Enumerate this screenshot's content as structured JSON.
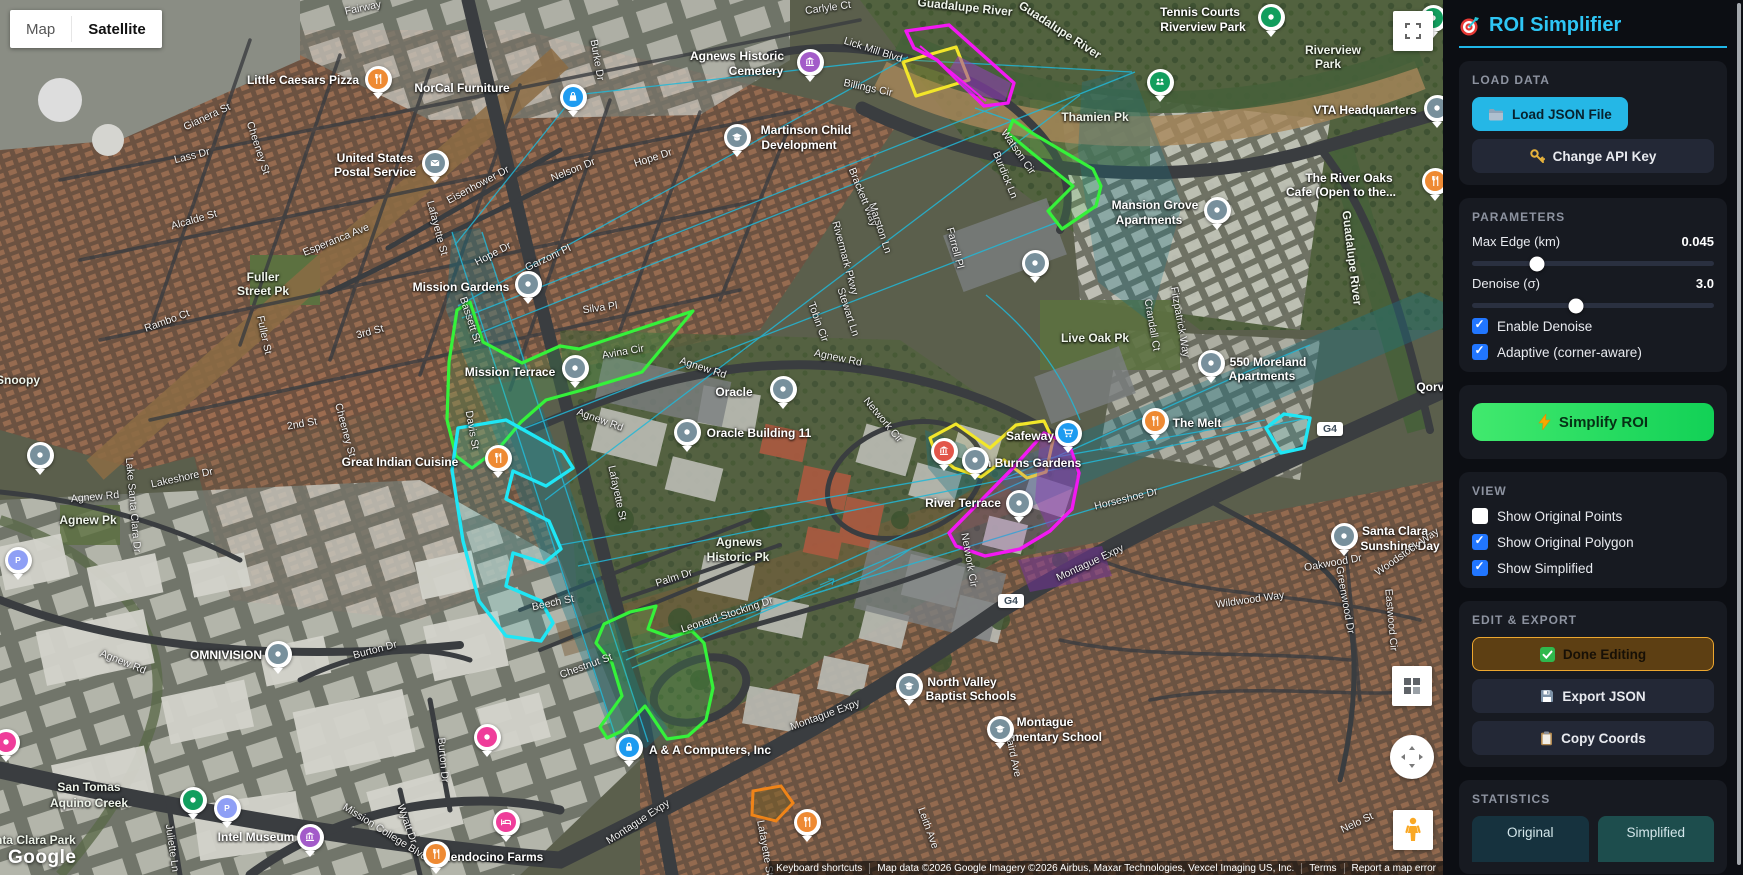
{
  "sidebar": {
    "title": "ROI Simplifier",
    "load": {
      "header": "LOAD DATA",
      "load_button": "Load JSON File",
      "api_button": "Change API Key"
    },
    "parameters": {
      "header": "PARAMETERS",
      "max_edge": {
        "label": "Max Edge (km)",
        "value": "0.045",
        "pct": 27
      },
      "denoise": {
        "label": "Denoise (σ)",
        "value": "3.0",
        "pct": 43
      },
      "checkboxes": [
        {
          "label": "Enable Denoise",
          "checked": true
        },
        {
          "label": "Adaptive (corner-aware)",
          "checked": true
        }
      ]
    },
    "simplify_button": "Simplify ROI",
    "view": {
      "header": "VIEW",
      "checkboxes": [
        {
          "label": "Show Original Points",
          "checked": false
        },
        {
          "label": "Show Original Polygon",
          "checked": true
        },
        {
          "label": "Show Simplified",
          "checked": true
        }
      ]
    },
    "edit": {
      "header": "EDIT & EXPORT",
      "done_button": "Done Editing",
      "export_button": "Export JSON",
      "copy_button": "Copy Coords"
    },
    "statistics": {
      "header": "STATISTICS",
      "original_label": "Original",
      "simplified_label": "Simplified"
    }
  },
  "map": {
    "type_control": {
      "map": "Map",
      "satellite": "Satellite"
    },
    "google_logo": "Google",
    "attribution": {
      "keyboard": "Keyboard shortcuts",
      "map_data": "Map data ©2026 Google Imagery ©2026 Airbus, Maxar Technologies, Vexcel Imaging US, Inc.",
      "terms": "Terms",
      "report": "Report a map error"
    },
    "highway_badges": [
      {
        "t": "G4",
        "x": 1330,
        "y": 429
      },
      {
        "t": "G4",
        "x": 1011,
        "y": 601
      }
    ],
    "roi_colors": {
      "original": "#22b8d8",
      "simplified_green": "#35f23a",
      "cyan": "#1fe6f5",
      "yellow": "#f2e62a",
      "magenta": "#f318f3",
      "orange": "#f08418"
    },
    "labels": [
      {
        "t": "Little Caesars Pizza",
        "x": 303,
        "y": 80,
        "r": 0,
        "k": "poi"
      },
      {
        "t": "NorCal Furniture",
        "x": 462,
        "y": 88,
        "r": 0,
        "k": "poi"
      },
      {
        "t": "United States",
        "x": 375,
        "y": 158,
        "r": 0,
        "k": "poi"
      },
      {
        "t": "Postal Service",
        "x": 375,
        "y": 172,
        "r": 0,
        "k": "poi"
      },
      {
        "t": "Agnews Historic",
        "x": 737,
        "y": 56,
        "r": 0,
        "k": "poi"
      },
      {
        "t": "Cemetery",
        "x": 756,
        "y": 71,
        "r": 0,
        "k": "poi"
      },
      {
        "t": "Martinson Child",
        "x": 806,
        "y": 130,
        "r": 0,
        "k": "poi"
      },
      {
        "t": "Development",
        "x": 799,
        "y": 145,
        "r": 0,
        "k": "poi"
      },
      {
        "t": "Tennis Courts",
        "x": 1200,
        "y": 12,
        "r": 0,
        "k": "poi"
      },
      {
        "t": "Riverview Park",
        "x": 1203,
        "y": 27,
        "r": 0,
        "k": "poi"
      },
      {
        "t": "Riverview",
        "x": 1333,
        "y": 50,
        "r": 0,
        "k": "park"
      },
      {
        "t": "Park",
        "x": 1328,
        "y": 64,
        "r": 0,
        "k": "park"
      },
      {
        "t": "VTA Headquarters",
        "x": 1365,
        "y": 110,
        "r": 0,
        "k": "poi"
      },
      {
        "t": "The River Oaks",
        "x": 1349,
        "y": 178,
        "r": 0,
        "k": "poi"
      },
      {
        "t": "Cafe (Open to the...",
        "x": 1341,
        "y": 192,
        "r": 0,
        "k": "poi"
      },
      {
        "t": "Mansion Grove",
        "x": 1155,
        "y": 205,
        "r": 0,
        "k": "poi"
      },
      {
        "t": "Apartments",
        "x": 1149,
        "y": 220,
        "r": 0,
        "k": "poi"
      },
      {
        "t": "550 Moreland",
        "x": 1268,
        "y": 362,
        "r": 0,
        "k": "poi"
      },
      {
        "t": "Apartments",
        "x": 1262,
        "y": 376,
        "r": 0,
        "k": "poi"
      },
      {
        "t": "The Melt",
        "x": 1197,
        "y": 423,
        "r": 0,
        "k": "poi"
      },
      {
        "t": "Safeway",
        "x": 1030,
        "y": 436,
        "r": 0,
        "k": "poi"
      },
      {
        "t": "John Burns Gardens",
        "x": 1022,
        "y": 463,
        "r": 0,
        "k": "poi"
      },
      {
        "t": "River Terrace",
        "x": 963,
        "y": 503,
        "r": 0,
        "k": "poi"
      },
      {
        "t": "Mission Gardens",
        "x": 461,
        "y": 287,
        "r": 0,
        "k": "poi"
      },
      {
        "t": "Mission Terrace",
        "x": 510,
        "y": 372,
        "r": 0,
        "k": "poi"
      },
      {
        "t": "Oracle",
        "x": 734,
        "y": 392,
        "r": 0,
        "k": "poi"
      },
      {
        "t": "Oracle Building 11",
        "x": 759,
        "y": 433,
        "r": 0,
        "k": "poi"
      },
      {
        "t": "Great Indian Cuisine",
        "x": 400,
        "y": 462,
        "r": 0,
        "k": "poi"
      },
      {
        "t": "A & A Computers, Inc",
        "x": 710,
        "y": 750,
        "r": 0,
        "k": "poi"
      },
      {
        "t": "North Valley",
        "x": 962,
        "y": 682,
        "r": 0,
        "k": "poi"
      },
      {
        "t": "Baptist Schools",
        "x": 971,
        "y": 696,
        "r": 0,
        "k": "poi"
      },
      {
        "t": "Mendocino Farms",
        "x": 492,
        "y": 857,
        "r": 0,
        "k": "poi"
      },
      {
        "t": "Intel Museum",
        "x": 256,
        "y": 837,
        "r": 0,
        "k": "poi"
      },
      {
        "t": "OMNIVISION",
        "x": 226,
        "y": 655,
        "r": 0,
        "k": "poi"
      },
      {
        "t": "Montague",
        "x": 1045,
        "y": 722,
        "r": 0,
        "k": "poi"
      },
      {
        "t": "Elementary School",
        "x": 1048,
        "y": 737,
        "r": 0,
        "k": "poi"
      },
      {
        "t": "Santa Clara",
        "x": 1395,
        "y": 531,
        "r": 0,
        "k": "poi"
      },
      {
        "t": "Sunshine Day",
        "x": 1400,
        "y": 546,
        "r": 0,
        "k": "poi"
      },
      {
        "t": "Qorvo",
        "x": 1434,
        "y": 387,
        "r": 0,
        "k": "poi"
      },
      {
        "t": "Thamien Pk",
        "x": 1095,
        "y": 117,
        "r": 0,
        "k": "park"
      },
      {
        "t": "Live Oak Pk",
        "x": 1095,
        "y": 338,
        "r": 0,
        "k": "park"
      },
      {
        "t": "Agnews",
        "x": 739,
        "y": 542,
        "r": 0,
        "k": "park"
      },
      {
        "t": "Historic Pk",
        "x": 738,
        "y": 557,
        "r": 0,
        "k": "park"
      },
      {
        "t": "Fuller",
        "x": 263,
        "y": 277,
        "r": 0,
        "k": "park"
      },
      {
        "t": "Street Pk",
        "x": 263,
        "y": 291,
        "r": 0,
        "k": "park"
      },
      {
        "t": "Agnew Pk",
        "x": 88,
        "y": 520,
        "r": 0,
        "k": "park"
      },
      {
        "t": "San Tomas",
        "x": 89,
        "y": 787,
        "r": 0,
        "k": "park"
      },
      {
        "t": "Aquino Creek",
        "x": 89,
        "y": 803,
        "r": 0,
        "k": "park"
      },
      {
        "t": "Santa Clara Park",
        "x": 28,
        "y": 840,
        "r": 0,
        "k": "park"
      },
      {
        "t": "Snoopy",
        "x": 18,
        "y": 380,
        "r": 0,
        "k": "park"
      },
      {
        "t": "Guadalupe River",
        "x": 965,
        "y": 7,
        "r": 6,
        "k": "park"
      },
      {
        "t": "Guadalupe River",
        "x": 1060,
        "y": 30,
        "r": 33,
        "k": "park"
      },
      {
        "t": "Guadalupe River",
        "x": 1352,
        "y": 258,
        "r": 83,
        "k": "park"
      },
      {
        "t": "Fairway",
        "x": 363,
        "y": 8,
        "r": -12,
        "k": "road"
      },
      {
        "t": "Carlyle Ct",
        "x": 828,
        "y": 8,
        "r": -8,
        "k": "road"
      },
      {
        "t": "Lick Mill Blvd",
        "x": 873,
        "y": 50,
        "r": 18,
        "k": "road"
      },
      {
        "t": "Billings Cir",
        "x": 868,
        "y": 88,
        "r": 12,
        "k": "road"
      },
      {
        "t": "Burke Dr",
        "x": 597,
        "y": 60,
        "r": 80,
        "k": "road"
      },
      {
        "t": "Hope Dr",
        "x": 653,
        "y": 158,
        "r": -18,
        "k": "road"
      },
      {
        "t": "Nelson Dr",
        "x": 573,
        "y": 170,
        "r": -22,
        "k": "road"
      },
      {
        "t": "Eisenhower Dr",
        "x": 478,
        "y": 185,
        "r": -28,
        "k": "road"
      },
      {
        "t": "Hope Dr",
        "x": 493,
        "y": 254,
        "r": -28,
        "k": "road"
      },
      {
        "t": "Garzoni Pl",
        "x": 548,
        "y": 258,
        "r": -25,
        "k": "road"
      },
      {
        "t": "Silva Pl",
        "x": 600,
        "y": 308,
        "r": -8,
        "k": "road"
      },
      {
        "t": "Avina Cir",
        "x": 623,
        "y": 352,
        "r": -10,
        "k": "road"
      },
      {
        "t": "Lass Dr",
        "x": 192,
        "y": 156,
        "r": -14,
        "k": "road"
      },
      {
        "t": "Gianera St",
        "x": 207,
        "y": 117,
        "r": -25,
        "k": "road"
      },
      {
        "t": "Cheeney St",
        "x": 258,
        "y": 148,
        "r": 72,
        "k": "road"
      },
      {
        "t": "Cheeney St",
        "x": 345,
        "y": 430,
        "r": 75,
        "k": "road"
      },
      {
        "t": "Alcalde St",
        "x": 194,
        "y": 220,
        "r": -16,
        "k": "road"
      },
      {
        "t": "Esperanca Ave",
        "x": 336,
        "y": 240,
        "r": -22,
        "k": "road"
      },
      {
        "t": "Rambo Ct",
        "x": 167,
        "y": 321,
        "r": -20,
        "k": "road"
      },
      {
        "t": "Fuller St",
        "x": 264,
        "y": 335,
        "r": 78,
        "k": "road"
      },
      {
        "t": "3rd St",
        "x": 370,
        "y": 332,
        "r": -15,
        "k": "road"
      },
      {
        "t": "Bassett St",
        "x": 470,
        "y": 320,
        "r": 72,
        "k": "road"
      },
      {
        "t": "Lafayette St",
        "x": 437,
        "y": 228,
        "r": 75,
        "k": "road"
      },
      {
        "t": "Lafayette St",
        "x": 617,
        "y": 493,
        "r": 78,
        "k": "road"
      },
      {
        "t": "Lafayette St",
        "x": 765,
        "y": 848,
        "r": 80,
        "k": "road"
      },
      {
        "t": "Davis St",
        "x": 472,
        "y": 430,
        "r": 80,
        "k": "road"
      },
      {
        "t": "2nd St",
        "x": 302,
        "y": 424,
        "r": -10,
        "k": "road"
      },
      {
        "t": "Lakeshore Dr",
        "x": 182,
        "y": 478,
        "r": -12,
        "k": "road"
      },
      {
        "t": "Lake Santa Clara Dr",
        "x": 133,
        "y": 505,
        "r": 85,
        "k": "road"
      },
      {
        "t": "Agnew Rd",
        "x": 95,
        "y": 497,
        "r": -5,
        "k": "road"
      },
      {
        "t": "Agnew Rd",
        "x": 123,
        "y": 662,
        "r": 22,
        "k": "road"
      },
      {
        "t": "Agnew Rd",
        "x": 703,
        "y": 368,
        "r": 18,
        "k": "road"
      },
      {
        "t": "Agnew Rd",
        "x": 600,
        "y": 420,
        "r": 20,
        "k": "road"
      },
      {
        "t": "Agnew Rd",
        "x": 838,
        "y": 358,
        "r": 12,
        "k": "road"
      },
      {
        "t": "Brackett Way",
        "x": 863,
        "y": 197,
        "r": 68,
        "k": "road"
      },
      {
        "t": "Watson Cir",
        "x": 1018,
        "y": 152,
        "r": 55,
        "k": "road"
      },
      {
        "t": "Burdick Ln",
        "x": 1005,
        "y": 175,
        "r": 68,
        "k": "road"
      },
      {
        "t": "Marston Ln",
        "x": 880,
        "y": 228,
        "r": 72,
        "k": "road"
      },
      {
        "t": "Rivermark Pkwy",
        "x": 845,
        "y": 258,
        "r": 75,
        "k": "road"
      },
      {
        "t": "Farrell Pl",
        "x": 955,
        "y": 248,
        "r": 75,
        "k": "road"
      },
      {
        "t": "Stewart Ln",
        "x": 848,
        "y": 312,
        "r": 72,
        "k": "road"
      },
      {
        "t": "Tobin Cir",
        "x": 818,
        "y": 322,
        "r": 70,
        "k": "road"
      },
      {
        "t": "Network Cir",
        "x": 883,
        "y": 420,
        "r": 50,
        "k": "road"
      },
      {
        "t": "Network Cir",
        "x": 969,
        "y": 560,
        "r": 80,
        "k": "road"
      },
      {
        "t": "Horseshoe Dr",
        "x": 1126,
        "y": 499,
        "r": -14,
        "k": "road"
      },
      {
        "t": "Crandall Ct",
        "x": 1152,
        "y": 325,
        "r": 80,
        "k": "road"
      },
      {
        "t": "Fitzpatrick Way",
        "x": 1180,
        "y": 322,
        "r": 80,
        "k": "road"
      },
      {
        "t": "Montague Expy",
        "x": 825,
        "y": 715,
        "r": -20,
        "k": "road"
      },
      {
        "t": "Montague Expy",
        "x": 638,
        "y": 822,
        "r": -33,
        "k": "road"
      },
      {
        "t": "Montague Expy",
        "x": 1090,
        "y": 563,
        "r": -25,
        "k": "road"
      },
      {
        "t": "Leonard Stocking Dr",
        "x": 727,
        "y": 615,
        "r": -18,
        "k": "road"
      },
      {
        "t": "Palm Dr",
        "x": 674,
        "y": 578,
        "r": -18,
        "k": "road"
      },
      {
        "t": "Chestnut St",
        "x": 586,
        "y": 666,
        "r": -20,
        "k": "road"
      },
      {
        "t": "Beech St",
        "x": 553,
        "y": 603,
        "r": -12,
        "k": "road"
      },
      {
        "t": "Burton Dr",
        "x": 375,
        "y": 650,
        "r": -15,
        "k": "road"
      },
      {
        "t": "Burton Dr",
        "x": 443,
        "y": 760,
        "r": 85,
        "k": "road"
      },
      {
        "t": "Juliette Ln",
        "x": 172,
        "y": 848,
        "r": 82,
        "k": "road"
      },
      {
        "t": "Mission College Blvd",
        "x": 385,
        "y": 832,
        "r": 32,
        "k": "road"
      },
      {
        "t": "Wyatt Dr",
        "x": 407,
        "y": 824,
        "r": 70,
        "k": "road"
      },
      {
        "t": "Baird Ave",
        "x": 1013,
        "y": 755,
        "r": 78,
        "k": "road"
      },
      {
        "t": "Leith Ave",
        "x": 928,
        "y": 828,
        "r": 70,
        "k": "road"
      },
      {
        "t": "Greenwood Dr",
        "x": 1345,
        "y": 600,
        "r": 80,
        "k": "road"
      },
      {
        "t": "Eastwood Cir",
        "x": 1391,
        "y": 620,
        "r": 85,
        "k": "road"
      },
      {
        "t": "Wildwood Way",
        "x": 1250,
        "y": 600,
        "r": -8,
        "k": "road"
      },
      {
        "t": "Oakwood Dr",
        "x": 1333,
        "y": 563,
        "r": -10,
        "k": "road"
      },
      {
        "t": "Woodstock Way",
        "x": 1407,
        "y": 552,
        "r": -35,
        "k": "road"
      },
      {
        "t": "Nelo St",
        "x": 1357,
        "y": 823,
        "r": -25,
        "k": "road"
      }
    ],
    "markers": [
      {
        "k": "rest",
        "x": 378,
        "y": 79
      },
      {
        "k": "bag",
        "x": 573,
        "y": 97
      },
      {
        "k": "mail",
        "x": 435,
        "y": 163
      },
      {
        "k": "mus_p",
        "x": 810,
        "y": 62
      },
      {
        "k": "school",
        "x": 737,
        "y": 137
      },
      {
        "k": "tennis",
        "x": 1271,
        "y": 17
      },
      {
        "k": "ppl",
        "x": 1160,
        "y": 82
      },
      {
        "k": "green",
        "x": 1433,
        "y": 18
      },
      {
        "k": "gray",
        "x": 1035,
        "y": 263
      },
      {
        "k": "gray",
        "x": 528,
        "y": 284
      },
      {
        "k": "gray",
        "x": 575,
        "y": 368
      },
      {
        "k": "gray",
        "x": 783,
        "y": 389
      },
      {
        "k": "gray",
        "x": 687,
        "y": 432
      },
      {
        "k": "rest",
        "x": 498,
        "y": 458
      },
      {
        "k": "mus_r",
        "x": 944,
        "y": 451
      },
      {
        "k": "gray",
        "x": 975,
        "y": 460
      },
      {
        "k": "cart",
        "x": 1068,
        "y": 433
      },
      {
        "k": "rest",
        "x": 1155,
        "y": 421
      },
      {
        "k": "gray",
        "x": 1211,
        "y": 363
      },
      {
        "k": "gray",
        "x": 1217,
        "y": 210
      },
      {
        "k": "gray",
        "x": 1019,
        "y": 503
      },
      {
        "k": "gray",
        "x": 1344,
        "y": 536
      },
      {
        "k": "rest",
        "x": 1435,
        "y": 181
      },
      {
        "k": "gray",
        "x": 1437,
        "y": 108
      },
      {
        "k": "lock",
        "x": 629,
        "y": 747
      },
      {
        "k": "school",
        "x": 909,
        "y": 686
      },
      {
        "k": "rest",
        "x": 807,
        "y": 822
      },
      {
        "k": "gray",
        "x": 278,
        "y": 654
      },
      {
        "k": "green",
        "x": 193,
        "y": 800
      },
      {
        "k": "park_p",
        "x": 227,
        "y": 808
      },
      {
        "k": "mus_p",
        "x": 310,
        "y": 837
      },
      {
        "k": "rest",
        "x": 436,
        "y": 854
      },
      {
        "k": "hotel",
        "x": 506,
        "y": 822
      },
      {
        "k": "pink",
        "x": 487,
        "y": 737
      },
      {
        "k": "park_p",
        "x": 18,
        "y": 560
      },
      {
        "k": "gray",
        "x": 40,
        "y": 455
      },
      {
        "k": "pink",
        "x": 6,
        "y": 742
      },
      {
        "k": "school",
        "x": 1000,
        "y": 729
      }
    ]
  }
}
